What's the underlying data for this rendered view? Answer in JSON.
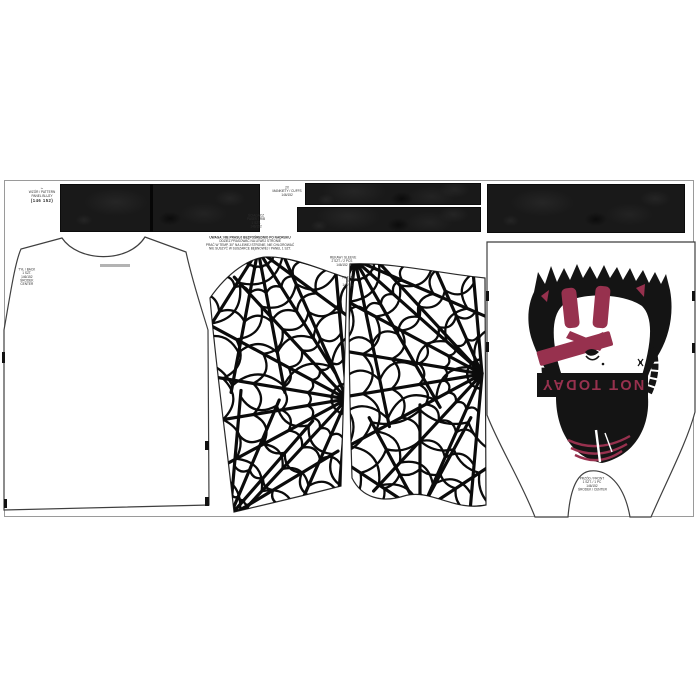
{
  "page": {
    "description": "Sewing fabric panel sheet – NOT TODAY spider web shirt, pattern pieces and ribbing"
  },
  "colors": {
    "crimson": "#97314e",
    "ink": "#141414",
    "rib_base": "#191919",
    "outline": "#3f3f3f",
    "panel_border": "#9a9a9a",
    "web": "#0b0b0b"
  },
  "banner": {
    "text": "NOT TODAY"
  },
  "corner_block": {
    "lines": [
      "✂",
      "WZÓR / PATTERN",
      "PANEL BLUZY",
      "(146 152)"
    ]
  },
  "center_note": {
    "lines": [
      "UWAGA: NIE PRASUJ BEZPOŚREDNIO PO NADRUKU",
      "ODZIEŻ PRASOWAĆ NA LEWEJ STRONIE",
      "PRAĆ W TEMP. 30° NA LEWEJ STRONIE, NIE CHLOROWAĆ",
      "NIE SUSZYĆ W SUSZARCE BĘBNOWEJ / PANEL 1 SZT."
    ]
  },
  "rib_label_top": {
    "lines": [
      "2X",
      "MANKIETY / CUFFS",
      "146/152"
    ]
  },
  "rib_label_bottom": {
    "lines": [
      "ŚCIĄGACZ",
      "PASEK / RIB",
      "1 SZT.",
      "146/152"
    ]
  },
  "sleeve_label_a": {
    "lines": [
      "RĘKAW / SLEEVE",
      "2 SZT. / 2 PCS",
      "146/152"
    ]
  },
  "sleeve_label_b": {
    "lines": [
      "RĘKAW",
      "2X",
      "146/152"
    ]
  },
  "back_label": {
    "lines": [
      "TYŁ / BACK",
      "1 SZT.",
      "146/152",
      "ŚRODEK",
      "CENTER"
    ]
  },
  "front_label": {
    "lines": [
      "PRZÓD / FRONT",
      "1 SZT. / 1 PC",
      "146/152",
      "ŚRODEK / CENTER"
    ]
  }
}
